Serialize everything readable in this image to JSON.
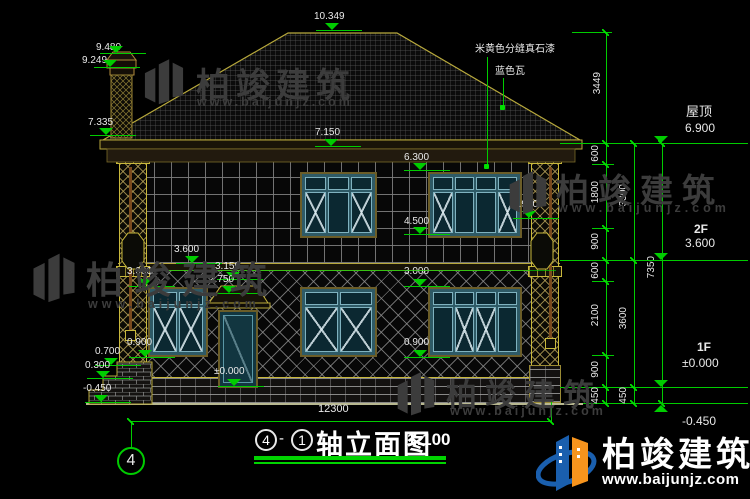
{
  "title_block": {
    "axis_start": "4",
    "separator": "-",
    "axis_end": "1",
    "name": "轴立面图",
    "scale": "1:100"
  },
  "axis_bubble": "4",
  "material_labels": {
    "stone_paint": "米黄色分缝真石漆",
    "blue_tile": "蓝色瓦"
  },
  "levels": {
    "ridge": "10.349",
    "chimney_top": "9.480",
    "chimney_cap": "9.249",
    "eave_left": "7.335",
    "eave_mid": "7.150",
    "win2f_top": "6.300",
    "win2f_sill": "4.500",
    "win2f_sill_right": "4.900",
    "floor2": "3.600",
    "canopy_top": "3.150",
    "canopy_bottom": "2.750",
    "win1f_top_left": "3.000",
    "win1f_top_right": "3.000",
    "win1f_sill_left": "0.900",
    "win1f_sill_right": "0.900",
    "porch": "0.700",
    "step": "0.300",
    "grade": "-0.450",
    "floor1_door": "±0.000"
  },
  "right_levels": {
    "roof_label": "屋顶",
    "roof_value": "6.900",
    "f2_label": "2F",
    "f2_value": "3.600",
    "f1_label": "1F",
    "f1_value": "±0.000",
    "grade_value": "-0.450"
  },
  "dim_chains": {
    "roof_height": "3449",
    "inner": [
      "600",
      "1800",
      "900",
      "600",
      "2100",
      "900",
      "450"
    ],
    "middle": [
      "3300",
      "3600",
      "450"
    ],
    "outer": "7350",
    "overall_width": "12300"
  },
  "watermark": {
    "name": "柏竣建筑",
    "url": "www.baijunjz.com"
  },
  "logo": {
    "name": "柏竣建筑",
    "url": "www.baijunjz.com"
  },
  "colors": {
    "background": "#000000",
    "dim_green": "#00cc00",
    "outline_olive": "#b8a93c",
    "window_teal": "#2e5a66",
    "logo_blue": "#1a5fae",
    "logo_orange": "#f7941d",
    "watermark_gray": "#3c3c3c"
  }
}
